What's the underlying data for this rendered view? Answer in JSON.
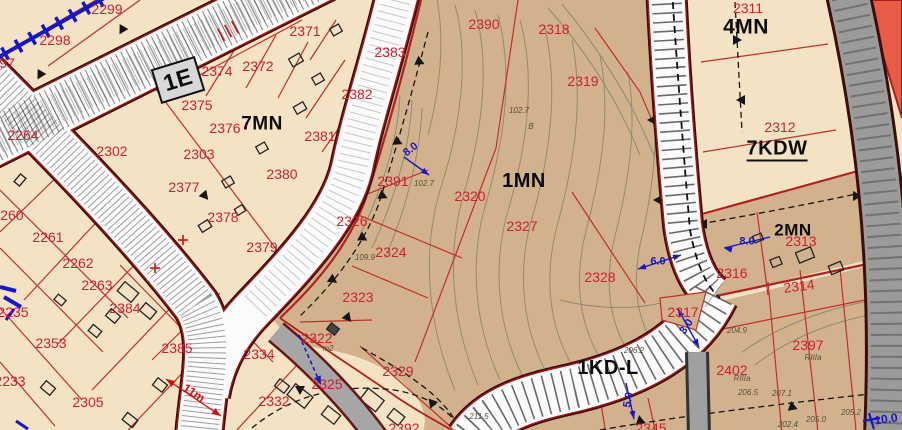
{
  "map": {
    "type": "zoning-plan-map",
    "colors": {
      "cream_zone": "#f3e2c3",
      "tan_zone": "#d2b28c",
      "road_white": "#fbfbfb",
      "road_border_dark": "#3a0c08",
      "road_border_red": "#a11616",
      "gray_road": "#9b9b9b",
      "orange_zone": "#e95b45",
      "parcel_number_red": "#cb2133",
      "boundary_red": "#c03028",
      "annotation_blue": "#1717c4",
      "contour_gray": "#8f8a74",
      "station_box_gray": "#d8d8d8"
    },
    "zone_labels": [
      {
        "t": "1E",
        "x": 178,
        "y": 80,
        "rot": -17,
        "size": 23
      },
      {
        "t": "7MN",
        "x": 262,
        "y": 124,
        "size": 19
      },
      {
        "t": "1MN",
        "x": 524,
        "y": 181,
        "size": 20
      },
      {
        "t": "4MN",
        "x": 746,
        "y": 27,
        "size": 21
      },
      {
        "t": "7KDW",
        "x": 777,
        "y": 150,
        "size": 20,
        "u": true
      },
      {
        "t": "2MN",
        "x": 793,
        "y": 230,
        "size": 17
      },
      {
        "t": "1KD-L",
        "x": 608,
        "y": 368,
        "size": 20
      }
    ],
    "parcel_labels": [
      {
        "t": "97",
        "x": 7,
        "y": 63
      },
      {
        "t": "2299",
        "x": 107,
        "y": 9
      },
      {
        "t": "2298",
        "x": 55,
        "y": 40
      },
      {
        "t": "2264",
        "x": 23,
        "y": 135
      },
      {
        "t": "2302",
        "x": 112,
        "y": 151
      },
      {
        "t": "2303",
        "x": 199,
        "y": 154
      },
      {
        "t": "2371",
        "x": 305,
        "y": 31
      },
      {
        "t": "2372",
        "x": 258,
        "y": 66
      },
      {
        "t": "2374",
        "x": 217,
        "y": 71
      },
      {
        "t": "2383",
        "x": 390,
        "y": 52
      },
      {
        "t": "2382",
        "x": 357,
        "y": 94
      },
      {
        "t": "2381",
        "x": 320,
        "y": 136
      },
      {
        "t": "2380",
        "x": 282,
        "y": 174
      },
      {
        "t": "2375",
        "x": 197,
        "y": 105
      },
      {
        "t": "2376",
        "x": 225,
        "y": 128
      },
      {
        "t": "2377",
        "x": 184,
        "y": 187
      },
      {
        "t": "2378",
        "x": 223,
        "y": 217
      },
      {
        "t": "2379",
        "x": 262,
        "y": 247
      },
      {
        "t": "2390",
        "x": 484,
        "y": 24
      },
      {
        "t": "2318",
        "x": 554,
        "y": 29
      },
      {
        "t": "2319",
        "x": 583,
        "y": 81
      },
      {
        "t": "2311",
        "x": 748,
        "y": 8
      },
      {
        "t": "2312",
        "x": 780,
        "y": 127
      },
      {
        "t": "2260",
        "x": 8,
        "y": 215
      },
      {
        "t": "2261",
        "x": 48,
        "y": 237
      },
      {
        "t": "2262",
        "x": 78,
        "y": 263
      },
      {
        "t": "2263",
        "x": 97,
        "y": 285
      },
      {
        "t": "2235",
        "x": 13,
        "y": 312
      },
      {
        "t": "2353",
        "x": 51,
        "y": 343
      },
      {
        "t": "2233",
        "x": 10,
        "y": 381
      },
      {
        "t": "2305",
        "x": 88,
        "y": 402
      },
      {
        "t": "2384",
        "x": 125,
        "y": 308
      },
      {
        "t": "2385",
        "x": 177,
        "y": 348
      },
      {
        "t": "2334",
        "x": 259,
        "y": 354
      },
      {
        "t": "2332",
        "x": 274,
        "y": 401
      },
      {
        "t": "2392",
        "x": 404,
        "y": 428
      },
      {
        "t": "2391",
        "x": 393,
        "y": 181
      },
      {
        "t": "2320",
        "x": 470,
        "y": 196
      },
      {
        "t": "2326",
        "x": 352,
        "y": 221
      },
      {
        "t": "2327",
        "x": 522,
        "y": 226
      },
      {
        "t": "2324",
        "x": 391,
        "y": 252
      },
      {
        "t": "2328",
        "x": 600,
        "y": 277
      },
      {
        "t": "2323",
        "x": 358,
        "y": 297
      },
      {
        "t": "2322",
        "x": 317,
        "y": 338
      },
      {
        "t": "2325",
        "x": 327,
        "y": 384
      },
      {
        "t": "2329",
        "x": 398,
        "y": 371
      },
      {
        "t": "2317",
        "x": 683,
        "y": 312
      },
      {
        "t": "2316",
        "x": 732,
        "y": 273
      },
      {
        "t": "2313",
        "x": 801,
        "y": 241
      },
      {
        "t": "2314",
        "x": 799,
        "y": 286,
        "rot": -7
      },
      {
        "t": "2397",
        "x": 808,
        "y": 345
      },
      {
        "t": "2402",
        "x": 732,
        "y": 370
      },
      {
        "t": "2345",
        "x": 651,
        "y": 428
      }
    ],
    "blue_dimensions": [
      {
        "t": "8.0",
        "x": 411,
        "y": 150,
        "rot": -38
      },
      {
        "t": "8.0",
        "x": 747,
        "y": 242
      },
      {
        "t": "6.0",
        "x": 658,
        "y": 262
      },
      {
        "t": "3.0",
        "x": 687,
        "y": 327,
        "rot": -55
      },
      {
        "t": "5.0",
        "x": 629,
        "y": 400,
        "rot": -80
      },
      {
        "t": "10.0",
        "x": 886,
        "y": 419,
        "rot": -8,
        "size": 12
      }
    ],
    "red_dimensions": [
      {
        "t": "11m",
        "x": 194,
        "y": 393,
        "rot": 33
      }
    ],
    "elevations": [
      {
        "t": "102.7",
        "x": 424,
        "y": 184
      },
      {
        "t": "102.7",
        "x": 519,
        "y": 111
      },
      {
        "t": "B",
        "x": 531,
        "y": 127
      },
      {
        "t": "109.9",
        "x": 365,
        "y": 258
      },
      {
        "t": "211.5",
        "x": 479,
        "y": 417
      },
      {
        "t": "206.5",
        "x": 748,
        "y": 393
      },
      {
        "t": "207.1",
        "x": 782,
        "y": 394
      },
      {
        "t": "205.0",
        "x": 816,
        "y": 420
      },
      {
        "t": "205.2",
        "x": 851,
        "y": 413
      },
      {
        "t": "202.4",
        "x": 788,
        "y": 425
      },
      {
        "t": "206.2",
        "x": 634,
        "y": 351
      },
      {
        "t": "204.9",
        "x": 737,
        "y": 331
      },
      {
        "t": "RIIIa",
        "x": 742,
        "y": 379
      },
      {
        "t": "RIIIa",
        "x": 813,
        "y": 358
      },
      {
        "t": "m2",
        "x": 328,
        "y": 349
      }
    ]
  }
}
